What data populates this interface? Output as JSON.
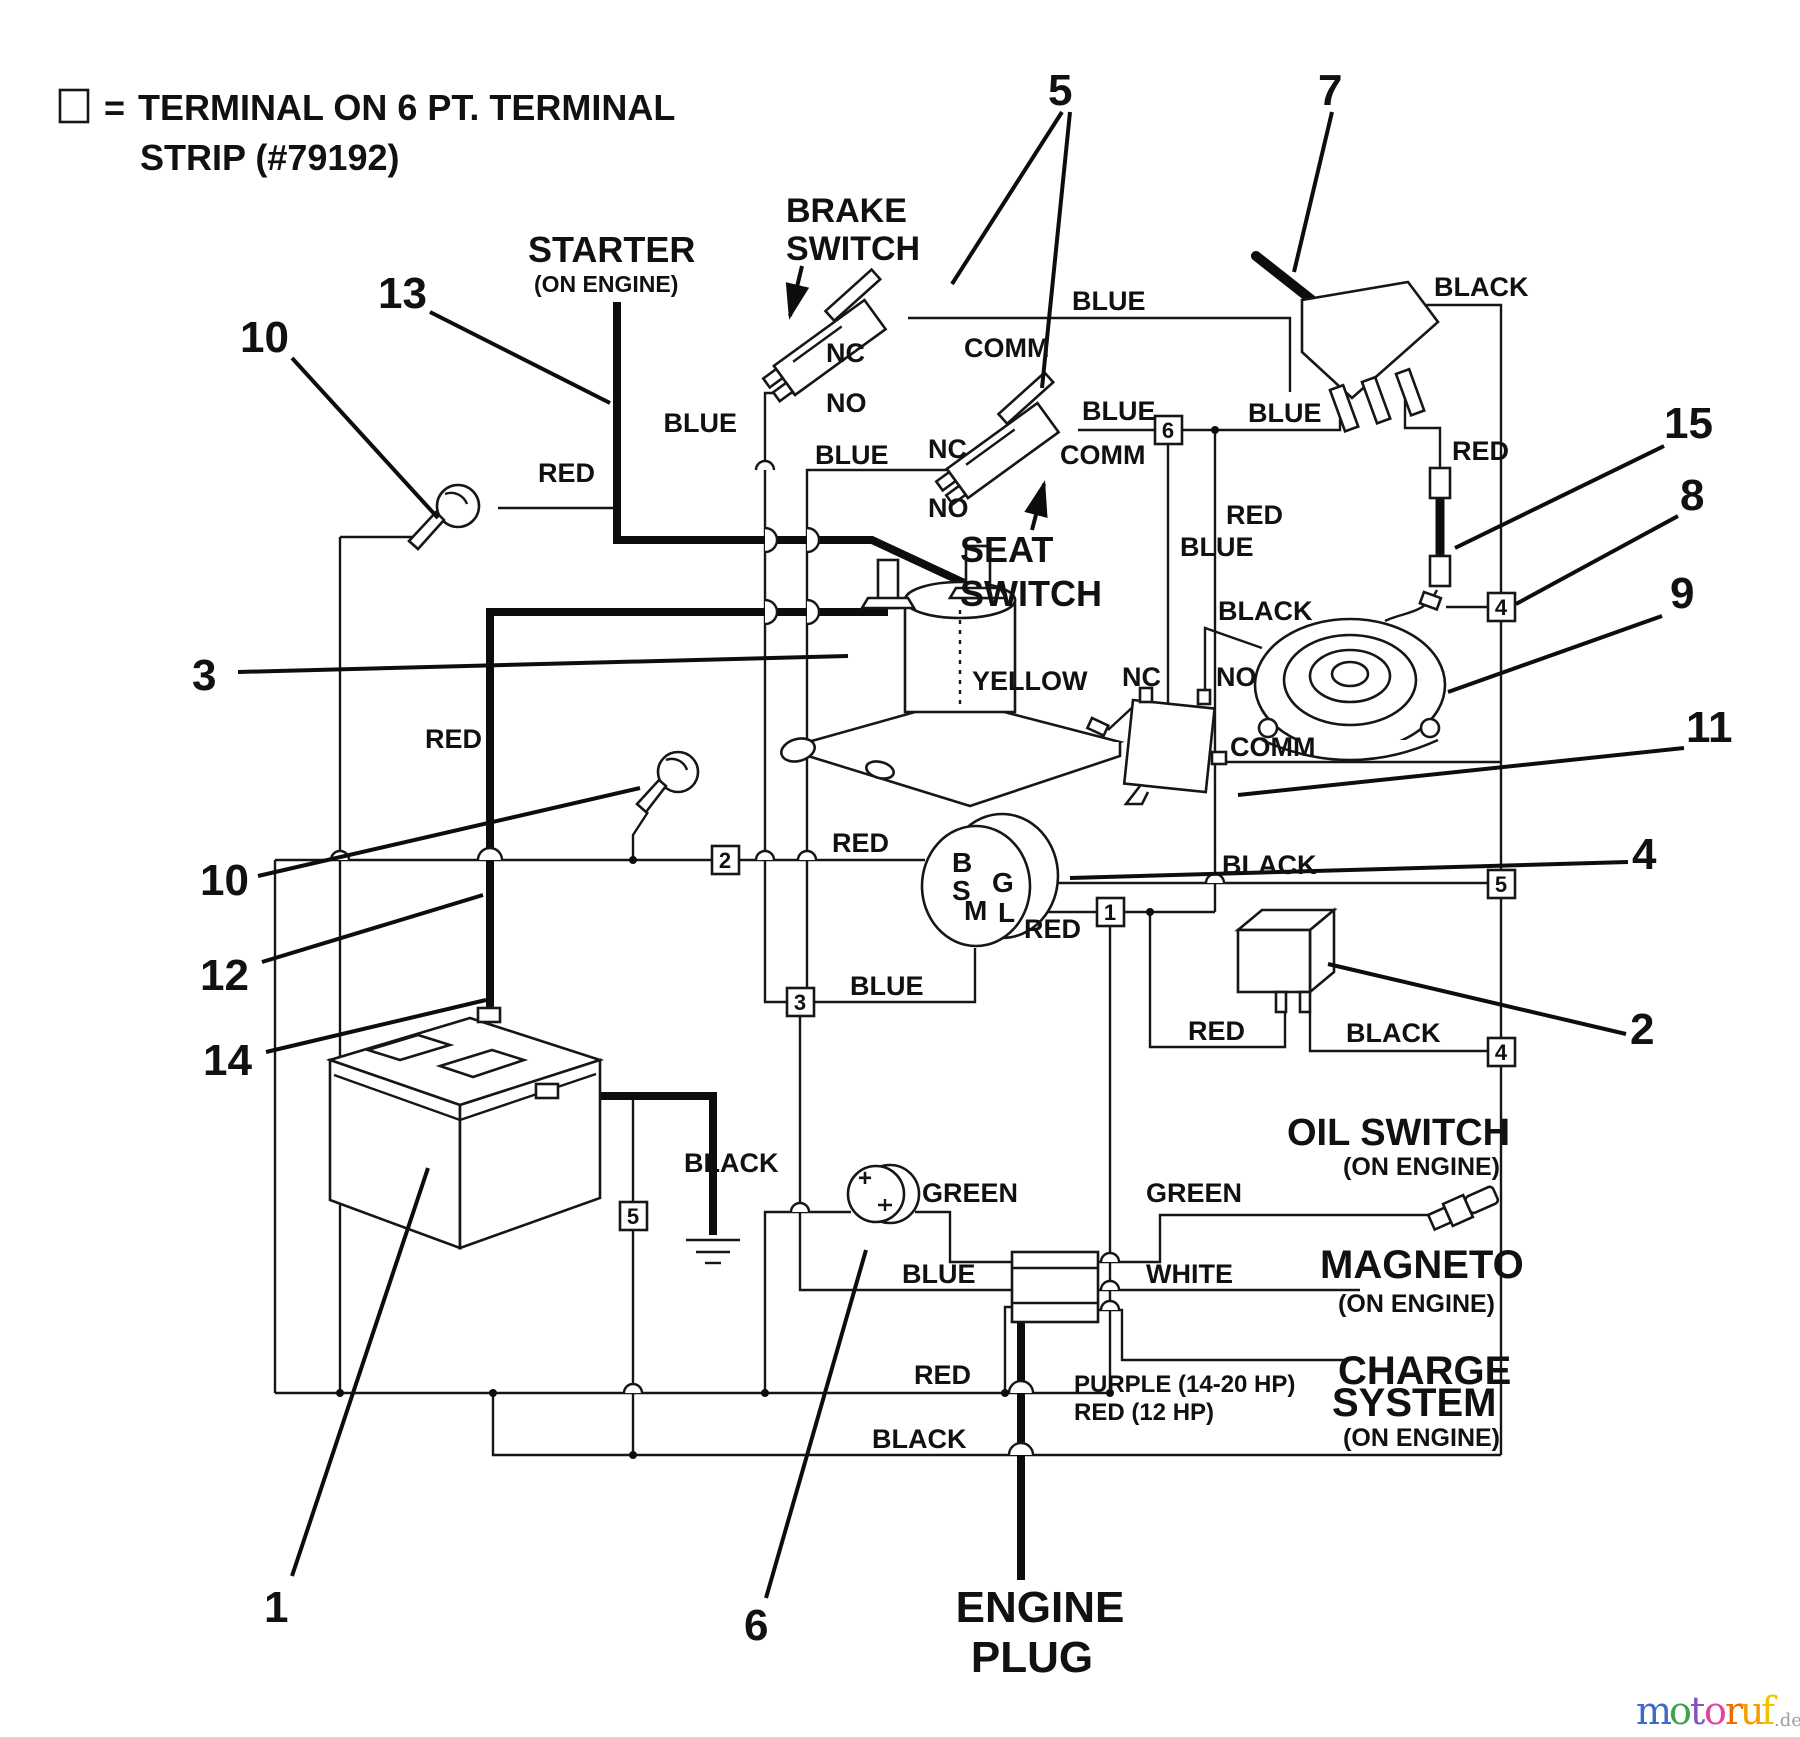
{
  "legend": {
    "eq": "=",
    "line1": "TERMINAL ON 6 PT. TERMINAL",
    "line2": "STRIP (#79192)"
  },
  "components": {
    "starter": "STARTER",
    "starter_sub": "(ON ENGINE)",
    "brake1": "BRAKE",
    "brake2": "SWITCH",
    "seat1": "SEAT",
    "seat2": "SWITCH",
    "oil": "OIL SWITCH",
    "oil_sub": "(ON ENGINE)",
    "magneto": "MAGNETO",
    "magneto_sub": "(ON ENGINE)",
    "charge1": "CHARGE",
    "charge2": "SYSTEM",
    "charge_sub": "(ON ENGINE)",
    "engine1": "ENGINE",
    "engine2": "PLUG",
    "gauge_plus": "+"
  },
  "switch_terminals": {
    "brake_nc": "NC",
    "brake_no": "NO",
    "brake_comm": "COMM",
    "seat_nc": "NC",
    "seat_no": "NO",
    "seat_comm": "COMM",
    "micro_nc": "NC",
    "micro_no": "NO",
    "micro_comm": "COMM"
  },
  "ignition_terminals": {
    "b": "B",
    "s": "S",
    "g": "G",
    "m": "M",
    "l": "L"
  },
  "wire_labels": {
    "red_starter": "RED",
    "red_cable": "RED",
    "red_key2": "RED",
    "red_ign_l": "RED",
    "red_toggle_down": "RED",
    "red_fuse": "RED",
    "red_bottom": "RED",
    "red_meter": "RED",
    "blue_brake_no": "BLUE",
    "blue_seat_nc": "BLUE",
    "blue_brake_comm": "BLUE",
    "blue_seat_6": "BLUE",
    "blue_6_toggle": "BLUE",
    "blue_6_down": "BLUE",
    "blue_3box": "BLUE",
    "blue_plug": "BLUE",
    "black_toggle": "BLACK",
    "black_micro": "BLACK",
    "black_ign_g": "BLACK",
    "black_meter": "BLACK",
    "black_battery": "BLACK",
    "black_bottom": "BLACK",
    "yellow": "YELLOW",
    "green_left": "GREEN",
    "green_right": "GREEN",
    "white": "WHITE",
    "purple_note1": "PURPLE (14-20 HP)",
    "purple_note2": "RED (12 HP)"
  },
  "callouts": {
    "c1": "1",
    "c2": "2",
    "c3": "3",
    "c4": "4",
    "c5": "5",
    "c6": "6",
    "c7": "7",
    "c8": "8",
    "c9": "9",
    "c10a": "10",
    "c10b": "10",
    "c11": "11",
    "c12": "12",
    "c13": "13",
    "c14": "14",
    "c15": "15"
  },
  "terminal_strip": {
    "t6": "6",
    "t2": "2",
    "t3": "3",
    "t1": "1",
    "t5_left": "5",
    "t4_upper": "4",
    "t5_right": "5",
    "t4_lower": "4"
  },
  "watermark": {
    "letters": [
      {
        "ch": "m",
        "color": "#3f6bc4"
      },
      {
        "ch": "o",
        "color": "#3fa347"
      },
      {
        "ch": "t",
        "color": "#8153bd"
      },
      {
        "ch": "o",
        "color": "#e0459e"
      },
      {
        "ch": "r",
        "color": "#ef6c00"
      },
      {
        "ch": "u",
        "color": "#f59d00"
      },
      {
        "ch": "f",
        "color": "#eec200"
      }
    ],
    "suffix": ".de",
    "suffix_color": "#9e9e9e"
  }
}
